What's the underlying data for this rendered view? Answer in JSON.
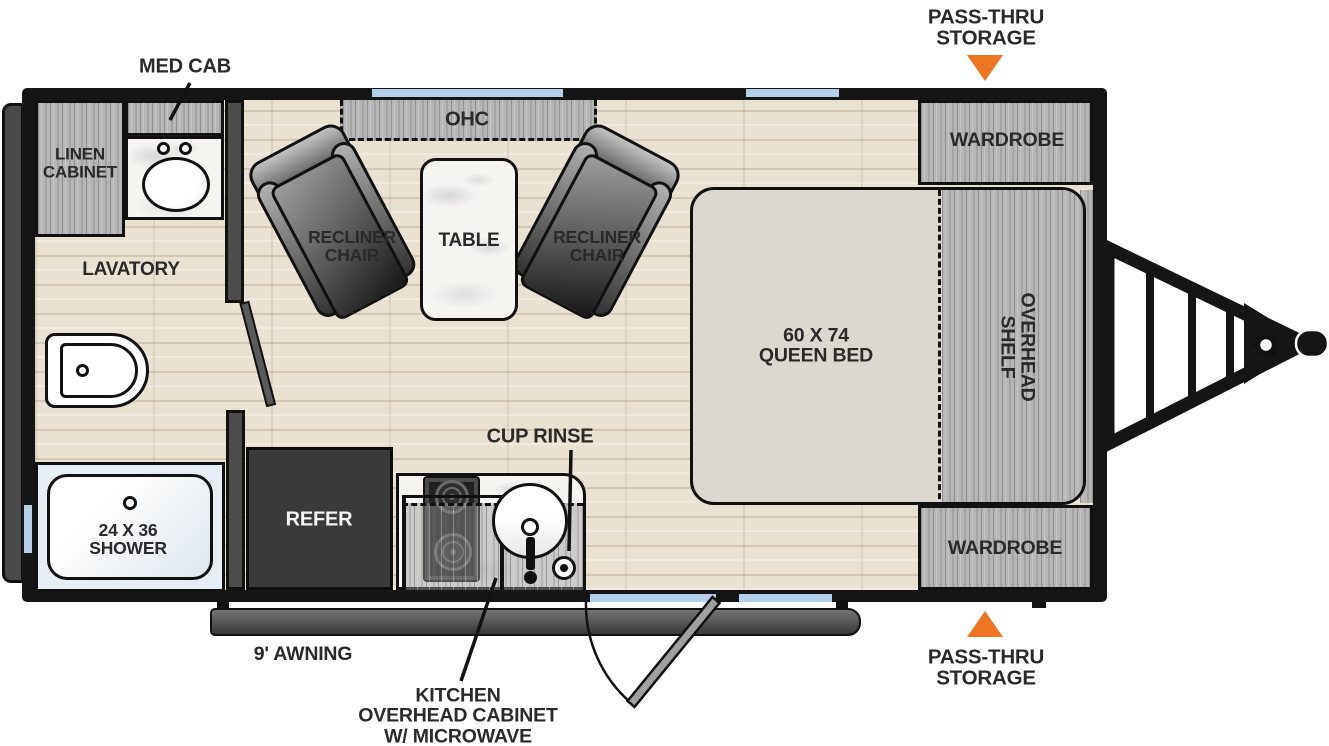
{
  "colors": {
    "accent_orange": "#ee7623",
    "window_blue": "#b5cfe9",
    "wall_black": "#151515",
    "label_text": "#2a2a2a"
  },
  "callouts": {
    "pass_thru_top": [
      "PASS-THRU",
      "STORAGE"
    ],
    "pass_thru_bottom": [
      "PASS-THRU",
      "STORAGE"
    ],
    "med_cab": "MED CAB",
    "cup_rinse": "CUP RINSE",
    "kitchen_ohc": [
      "KITCHEN",
      "OVERHEAD CABINET",
      "W/ MICROWAVE"
    ],
    "awning": "9' AWNING"
  },
  "rooms": {
    "linen_cabinet": [
      "LINEN",
      "CABINET"
    ],
    "lavatory": "LAVATORY",
    "shower": [
      "24 X 36",
      "SHOWER"
    ],
    "ohc": "OHC",
    "recliner_left": [
      "RECLINER",
      "CHAIR"
    ],
    "recliner_right": [
      "RECLINER",
      "CHAIR"
    ],
    "table": "TABLE",
    "bed": [
      "60 X 74",
      "QUEEN BED"
    ],
    "overhead_shelf": [
      "OVERHEAD",
      "SHELF"
    ],
    "wardrobe_top": "WARDROBE",
    "wardrobe_bottom": "WARDROBE",
    "refer": "REFER"
  }
}
